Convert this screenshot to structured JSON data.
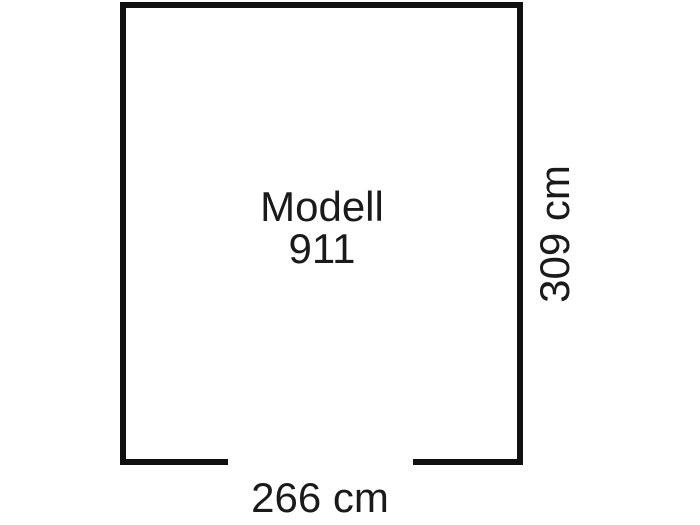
{
  "diagram": {
    "title_line1": "Modell",
    "title_line2": "911",
    "width_label": "266 cm",
    "height_label": "309 cm"
  },
  "colors": {
    "line": "#111111",
    "text": "#1a1a1a",
    "background": "#ffffff"
  }
}
